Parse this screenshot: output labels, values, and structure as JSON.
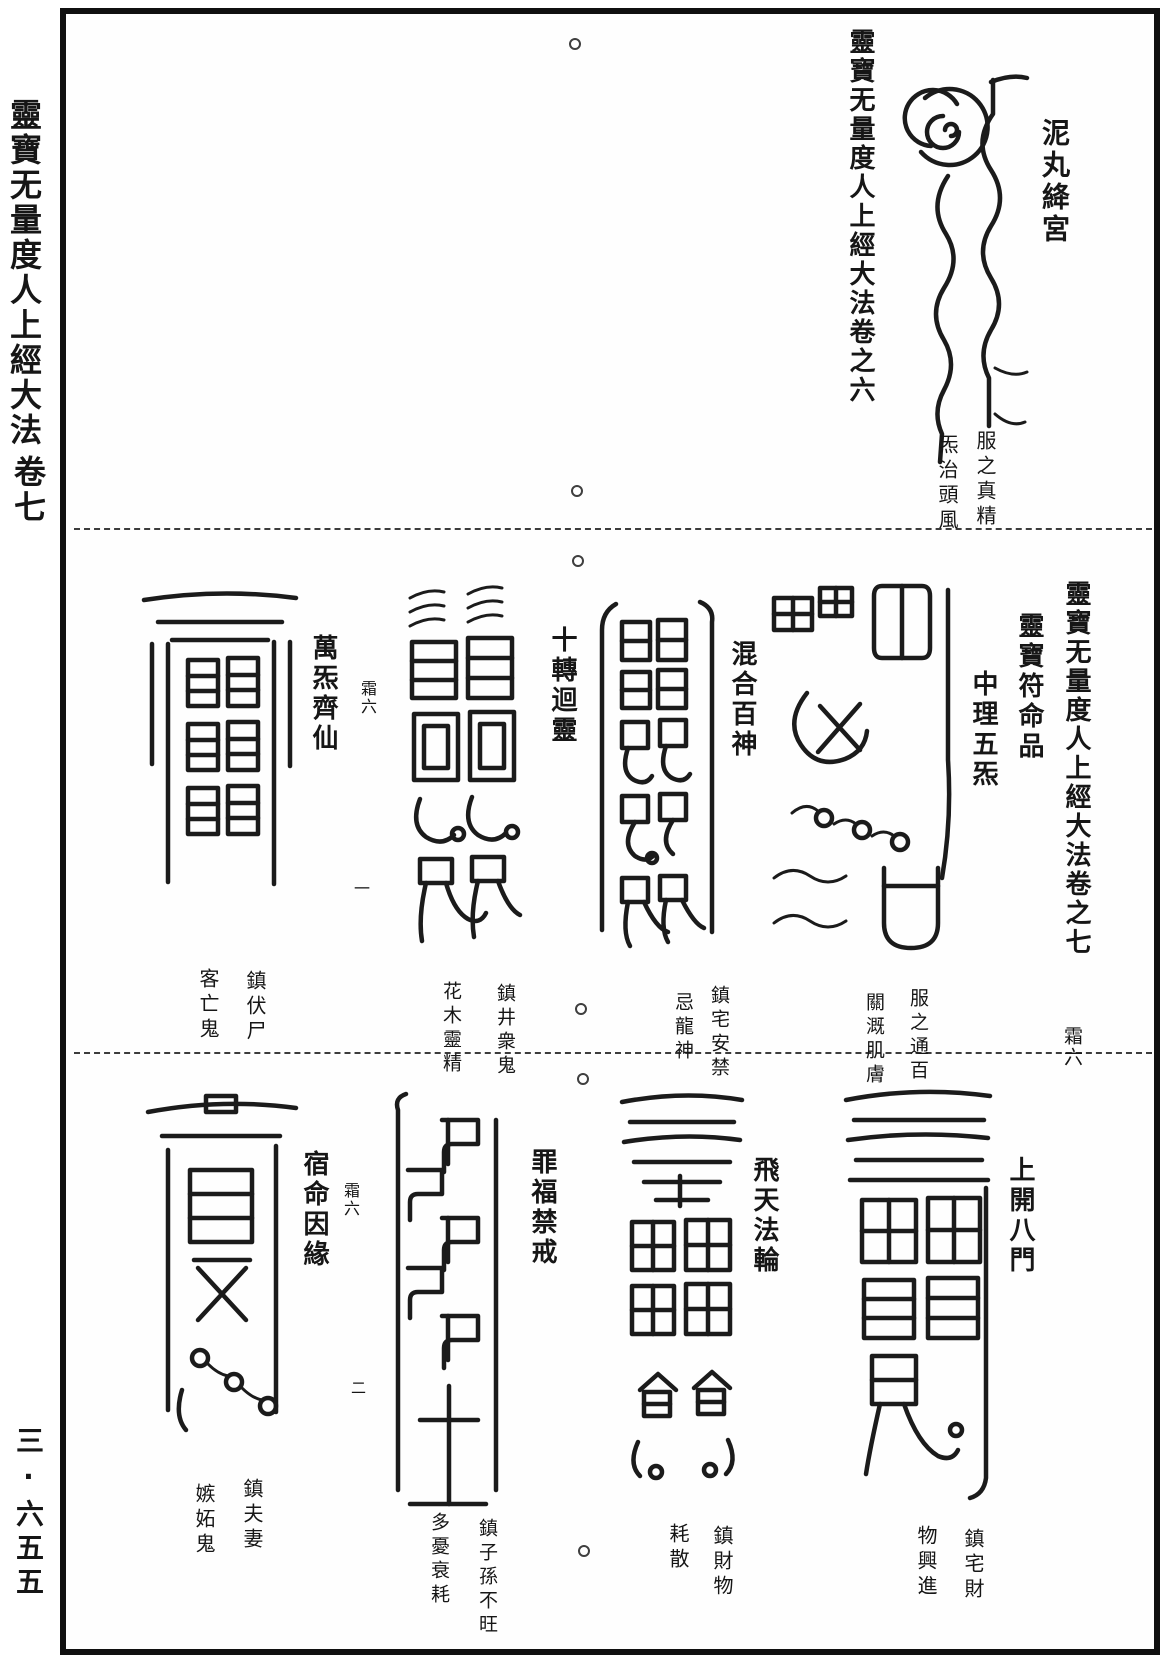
{
  "page": {
    "margin_title": "靈寶无量度人上經大法",
    "margin_volume": "卷七",
    "page_number": "三·六五五"
  },
  "top_section": {
    "closing_title": "靈寶无量度人上經大法卷之六",
    "talisman": {
      "label": "泥丸絳宮",
      "caption_right": "服之真精",
      "caption_left": "炁治頭風"
    }
  },
  "middle_section": {
    "opening_title": "靈寶无量度人上經大法卷之七",
    "chapter_title": "靈寶符命品",
    "fascicle_mark": "霜六",
    "leaf_mark": "一",
    "talismans": [
      {
        "label": "中理五炁",
        "caption_right": "服之通百",
        "caption_left": "關溉肌膚"
      },
      {
        "label": "混合百神",
        "caption_right": "鎮宅安禁",
        "caption_left": "忌龍神"
      },
      {
        "label": "十轉迴靈",
        "caption_right": "鎮井衆鬼",
        "caption_left": "花木靈精"
      },
      {
        "label": "萬炁齊仙",
        "fascicle_mark": "霜六",
        "caption_right": "鎮伏尸",
        "caption_left": "客亡鬼"
      }
    ]
  },
  "bottom_section": {
    "leaf_mark": "二",
    "talismans": [
      {
        "label": "上開八門",
        "caption_right": "鎮宅財",
        "caption_left": "物興進"
      },
      {
        "label": "飛天法輪",
        "caption_right": "鎮財物",
        "caption_left": "耗散"
      },
      {
        "label": "罪福禁戒",
        "caption_right": "鎮子孫不旺",
        "caption_left": "多憂衰耗"
      },
      {
        "label": "宿命因緣",
        "fascicle_mark": "霜六",
        "caption_right": "鎮夫妻",
        "caption_left": "嫉妬鬼"
      }
    ]
  }
}
